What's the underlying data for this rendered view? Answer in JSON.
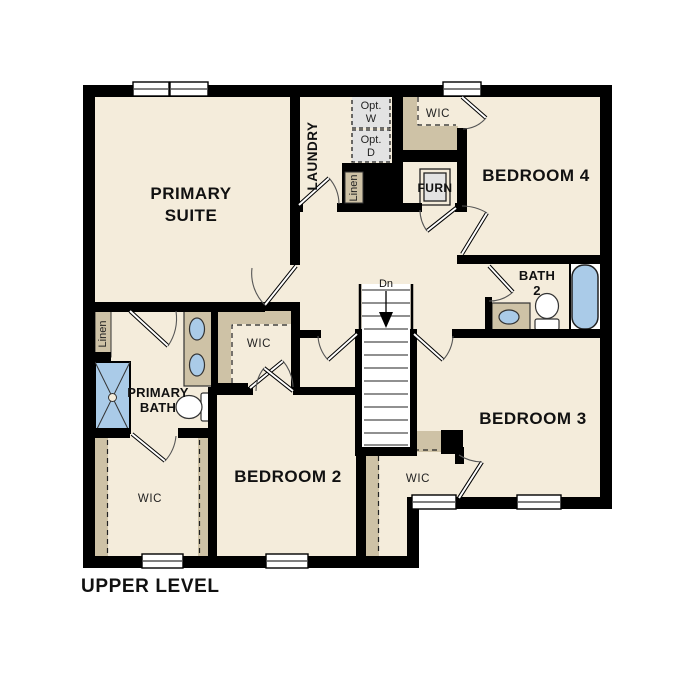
{
  "title": "UPPER LEVEL",
  "rooms": {
    "primary_suite": {
      "name_line1": "PRIMARY",
      "name_line2": "SUITE"
    },
    "laundry": {
      "name": "LAUNDRY"
    },
    "bedroom_4": {
      "name": "BEDROOM 4"
    },
    "bath_2": {
      "name_line1": "BATH",
      "name_line2": "2"
    },
    "bedroom_3": {
      "name": "BEDROOM 3"
    },
    "bedroom_2": {
      "name": "BEDROOM 2"
    },
    "primary_bath": {
      "name_line1": "PRIMARY",
      "name_line2": "BATH"
    },
    "wic_bedroom4": {
      "name": "WIC"
    },
    "wic_primary": {
      "name": "WIC"
    },
    "wic_bedroom3": {
      "name": "WIC"
    },
    "wic_bedroom2": {
      "name": "WIC"
    }
  },
  "closets": {
    "linen_hall": {
      "name": "Linen"
    },
    "linen_laundry": {
      "name": "Linen"
    },
    "furnace": {
      "name": "FURN"
    }
  },
  "appliances": {
    "optional_washer": {
      "name_line1": "Opt.",
      "name_line2": "W"
    },
    "optional_dryer": {
      "name_line1": "Opt.",
      "name_line2": "D"
    }
  },
  "stairs": {
    "direction_label": "Dn"
  },
  "colors": {
    "floor": "#f4ecdb",
    "wall": "#000000",
    "shelving": "#cec2a6",
    "fixture_blue": "#aacbe8",
    "appliance_gray": "#e3e3e3"
  }
}
